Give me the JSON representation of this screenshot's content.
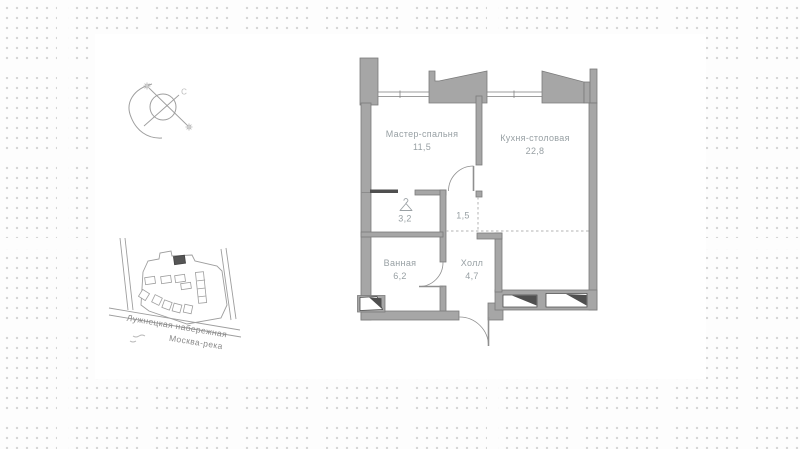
{
  "compass": {
    "north_label": "С"
  },
  "rooms": {
    "master_bedroom": {
      "name": "Мастер-спальня",
      "area": "11,5"
    },
    "kitchen_dining": {
      "name": "Кухня-столовая",
      "area": "22,8"
    },
    "wardrobe": {
      "area": "3,2"
    },
    "corridor": {
      "area": "1,5"
    },
    "bathroom": {
      "name": "Ванная",
      "area": "6,2"
    },
    "hall": {
      "name": "Холл",
      "area": "4,7"
    }
  },
  "site_map": {
    "street_label": "Лужнецкая набережная",
    "river_label": "Москва-река"
  },
  "colors": {
    "wall_fill": "#a6a6a6",
    "wall_outline": "#7b7b7b",
    "dark_accent": "#4f4f4f",
    "label_text": "#98a0a4",
    "map_stroke": "#9e9e9e",
    "dot_grid": "#d4d4d4",
    "panel_bg": "#ffffff"
  }
}
